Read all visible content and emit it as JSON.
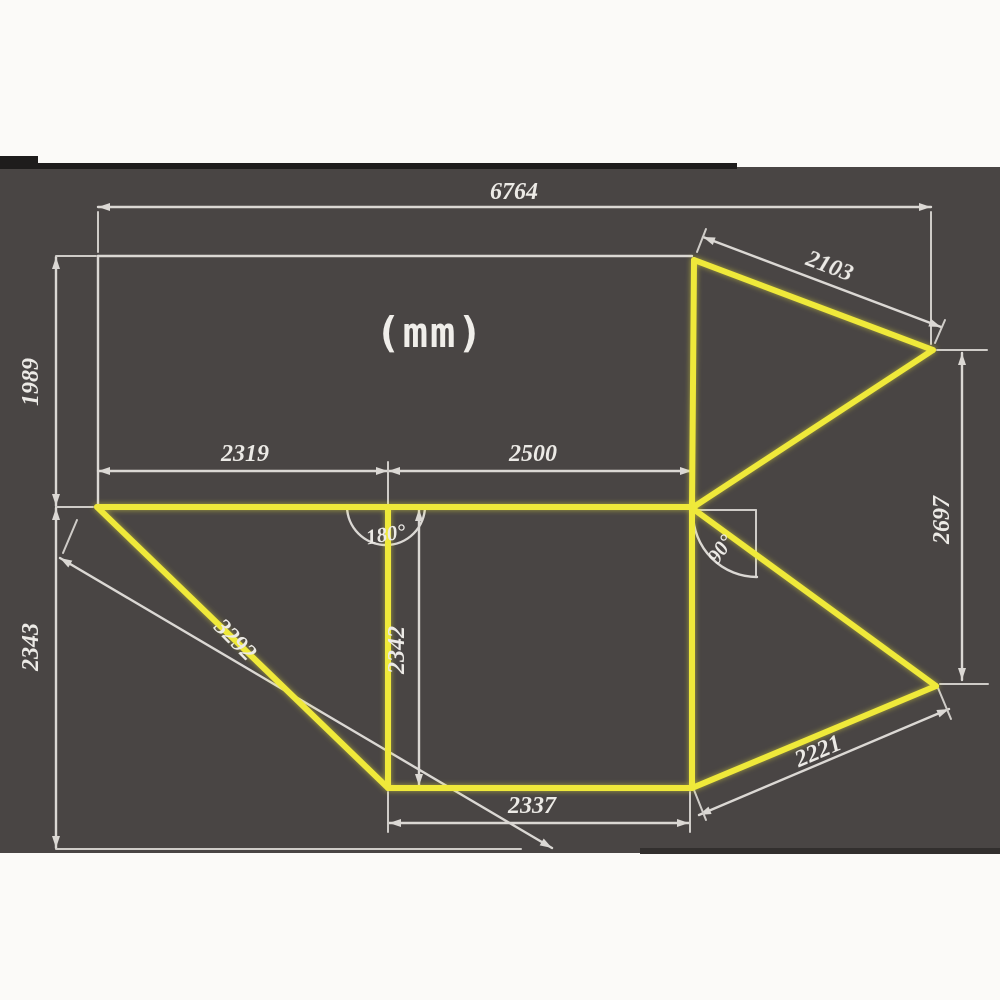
{
  "diagram": {
    "unit_label": "(mm)",
    "dimensions": {
      "top_width": "6764",
      "wing_top_edge": "2103",
      "left_upper_height": "1989",
      "left_panel_width": "2319",
      "middle_panel_width": "2500",
      "middle_panel_height": "2342",
      "left_lower_height": "2343",
      "left_hypotenuse": "3292",
      "bottom_width": "2337",
      "wing_bottom_edge": "2221",
      "right_height": "2697"
    },
    "angles": {
      "fold_flat": "180°",
      "fold_right": "90°"
    },
    "colors": {
      "page_background": "#fbfaf8",
      "panel_background": "#494544",
      "panel_top_strip": "#1e1c1c",
      "outline_white": "#dbd8d4",
      "awning_fabric_yellow": "#efe93a",
      "label_text": "#eceae6"
    }
  }
}
